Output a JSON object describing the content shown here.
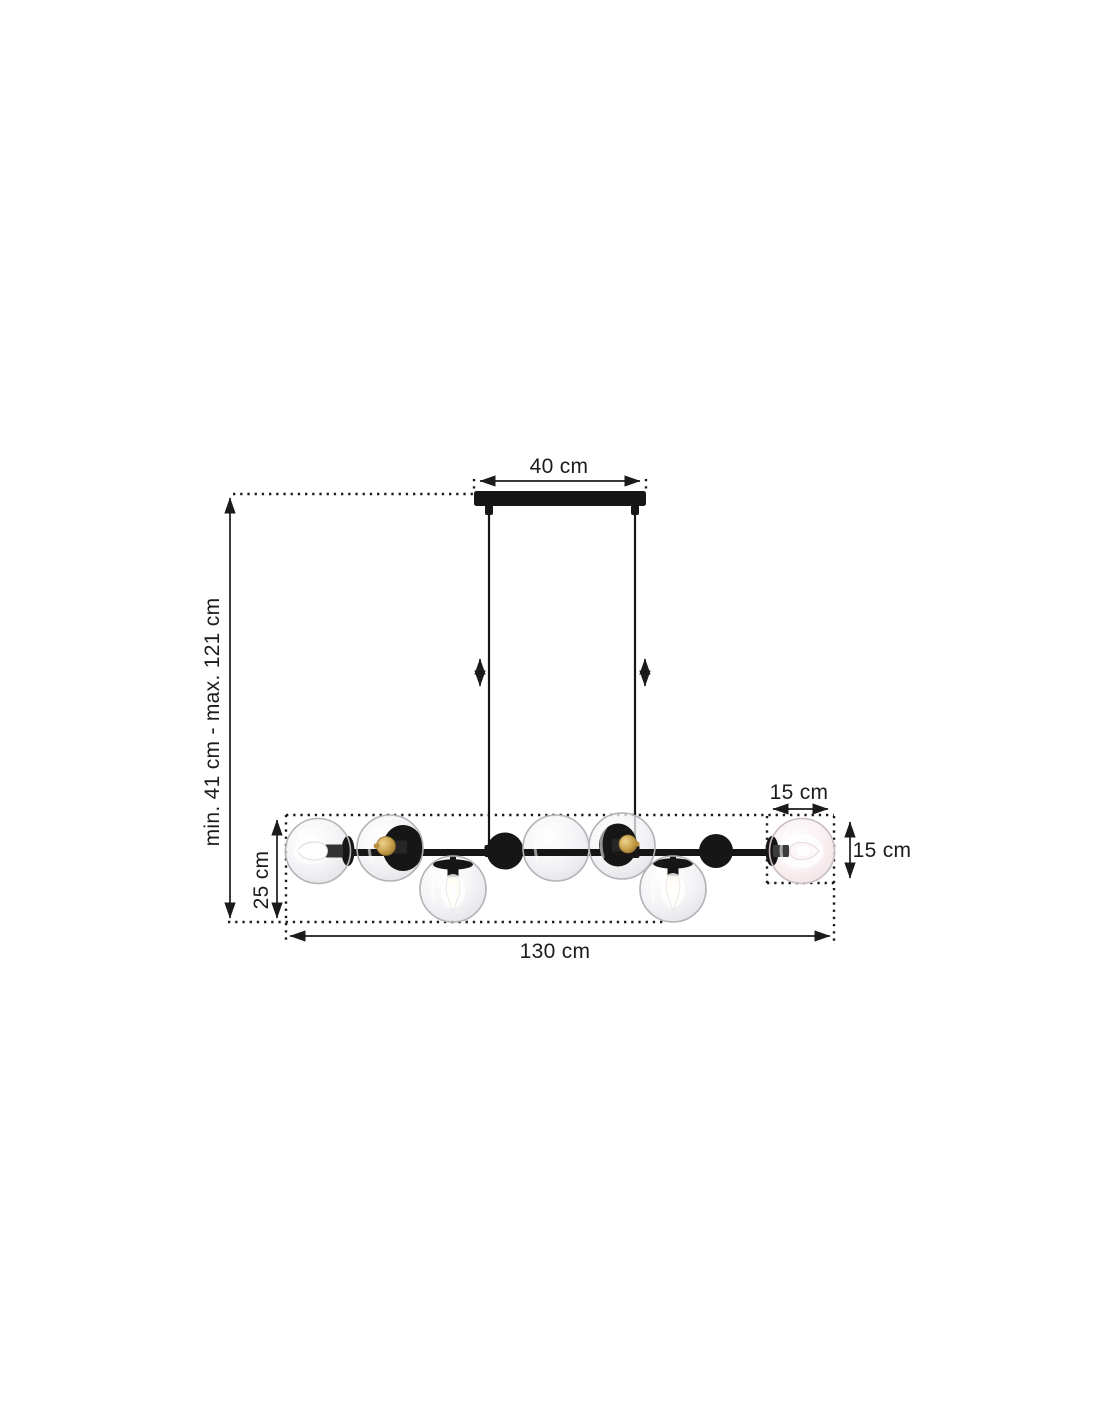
{
  "labels": {
    "canopy_width": "40 cm",
    "height_range": "min. 41 cm - max. 121 cm",
    "fixture_height": "25 cm",
    "fixture_width": "130 cm",
    "shade_width": "15 cm",
    "shade_height": "15 cm"
  },
  "colors": {
    "background": "#ffffff",
    "line": "#1b1b1b",
    "text": "#1c1c1c",
    "lamp_black": "#161616",
    "glass_stroke": "#b3b3b7",
    "bulb_gold": "#c9a24e",
    "glow_white": "#ffffff",
    "right_globe_tint": "#f6ecee"
  }
}
